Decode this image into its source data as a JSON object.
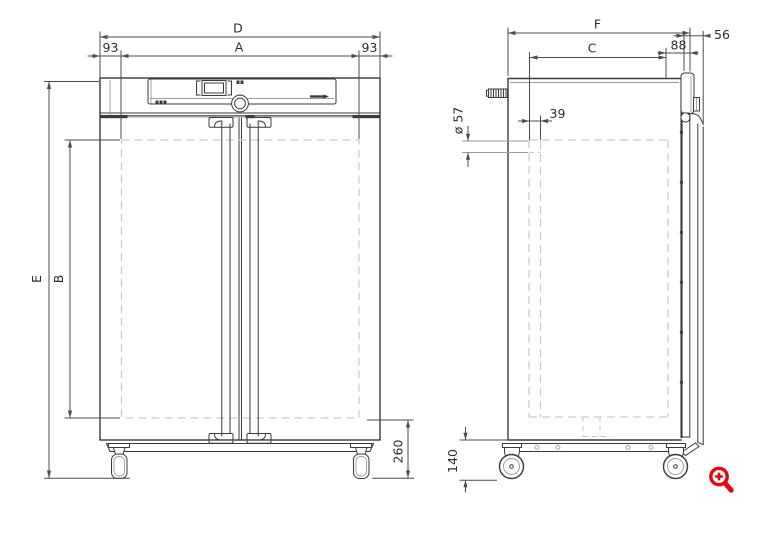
{
  "colors": {
    "line": "#3a3a3a",
    "dim": "#4d4d4d",
    "thin": "#9a9a9a",
    "dashed": "#c9c9c9",
    "accent_red": "#e30613",
    "text": "#2d2d2d",
    "background": "#ffffff"
  },
  "front_view": {
    "dim_labels": {
      "overall_width": "D",
      "inner_width": "A",
      "left_offset": "93",
      "right_offset": "93",
      "overall_height": "E",
      "inner_height": "B",
      "base_height": "260"
    }
  },
  "side_view": {
    "dim_labels": {
      "overall_depth": "F",
      "inner_depth": "C",
      "rear_gap": "88",
      "door_depth": "56",
      "port_offset": "39",
      "port_diameter": "ø 57",
      "caster_height": "140"
    }
  },
  "icons": {
    "zoom_icon_color": "#e30613"
  }
}
